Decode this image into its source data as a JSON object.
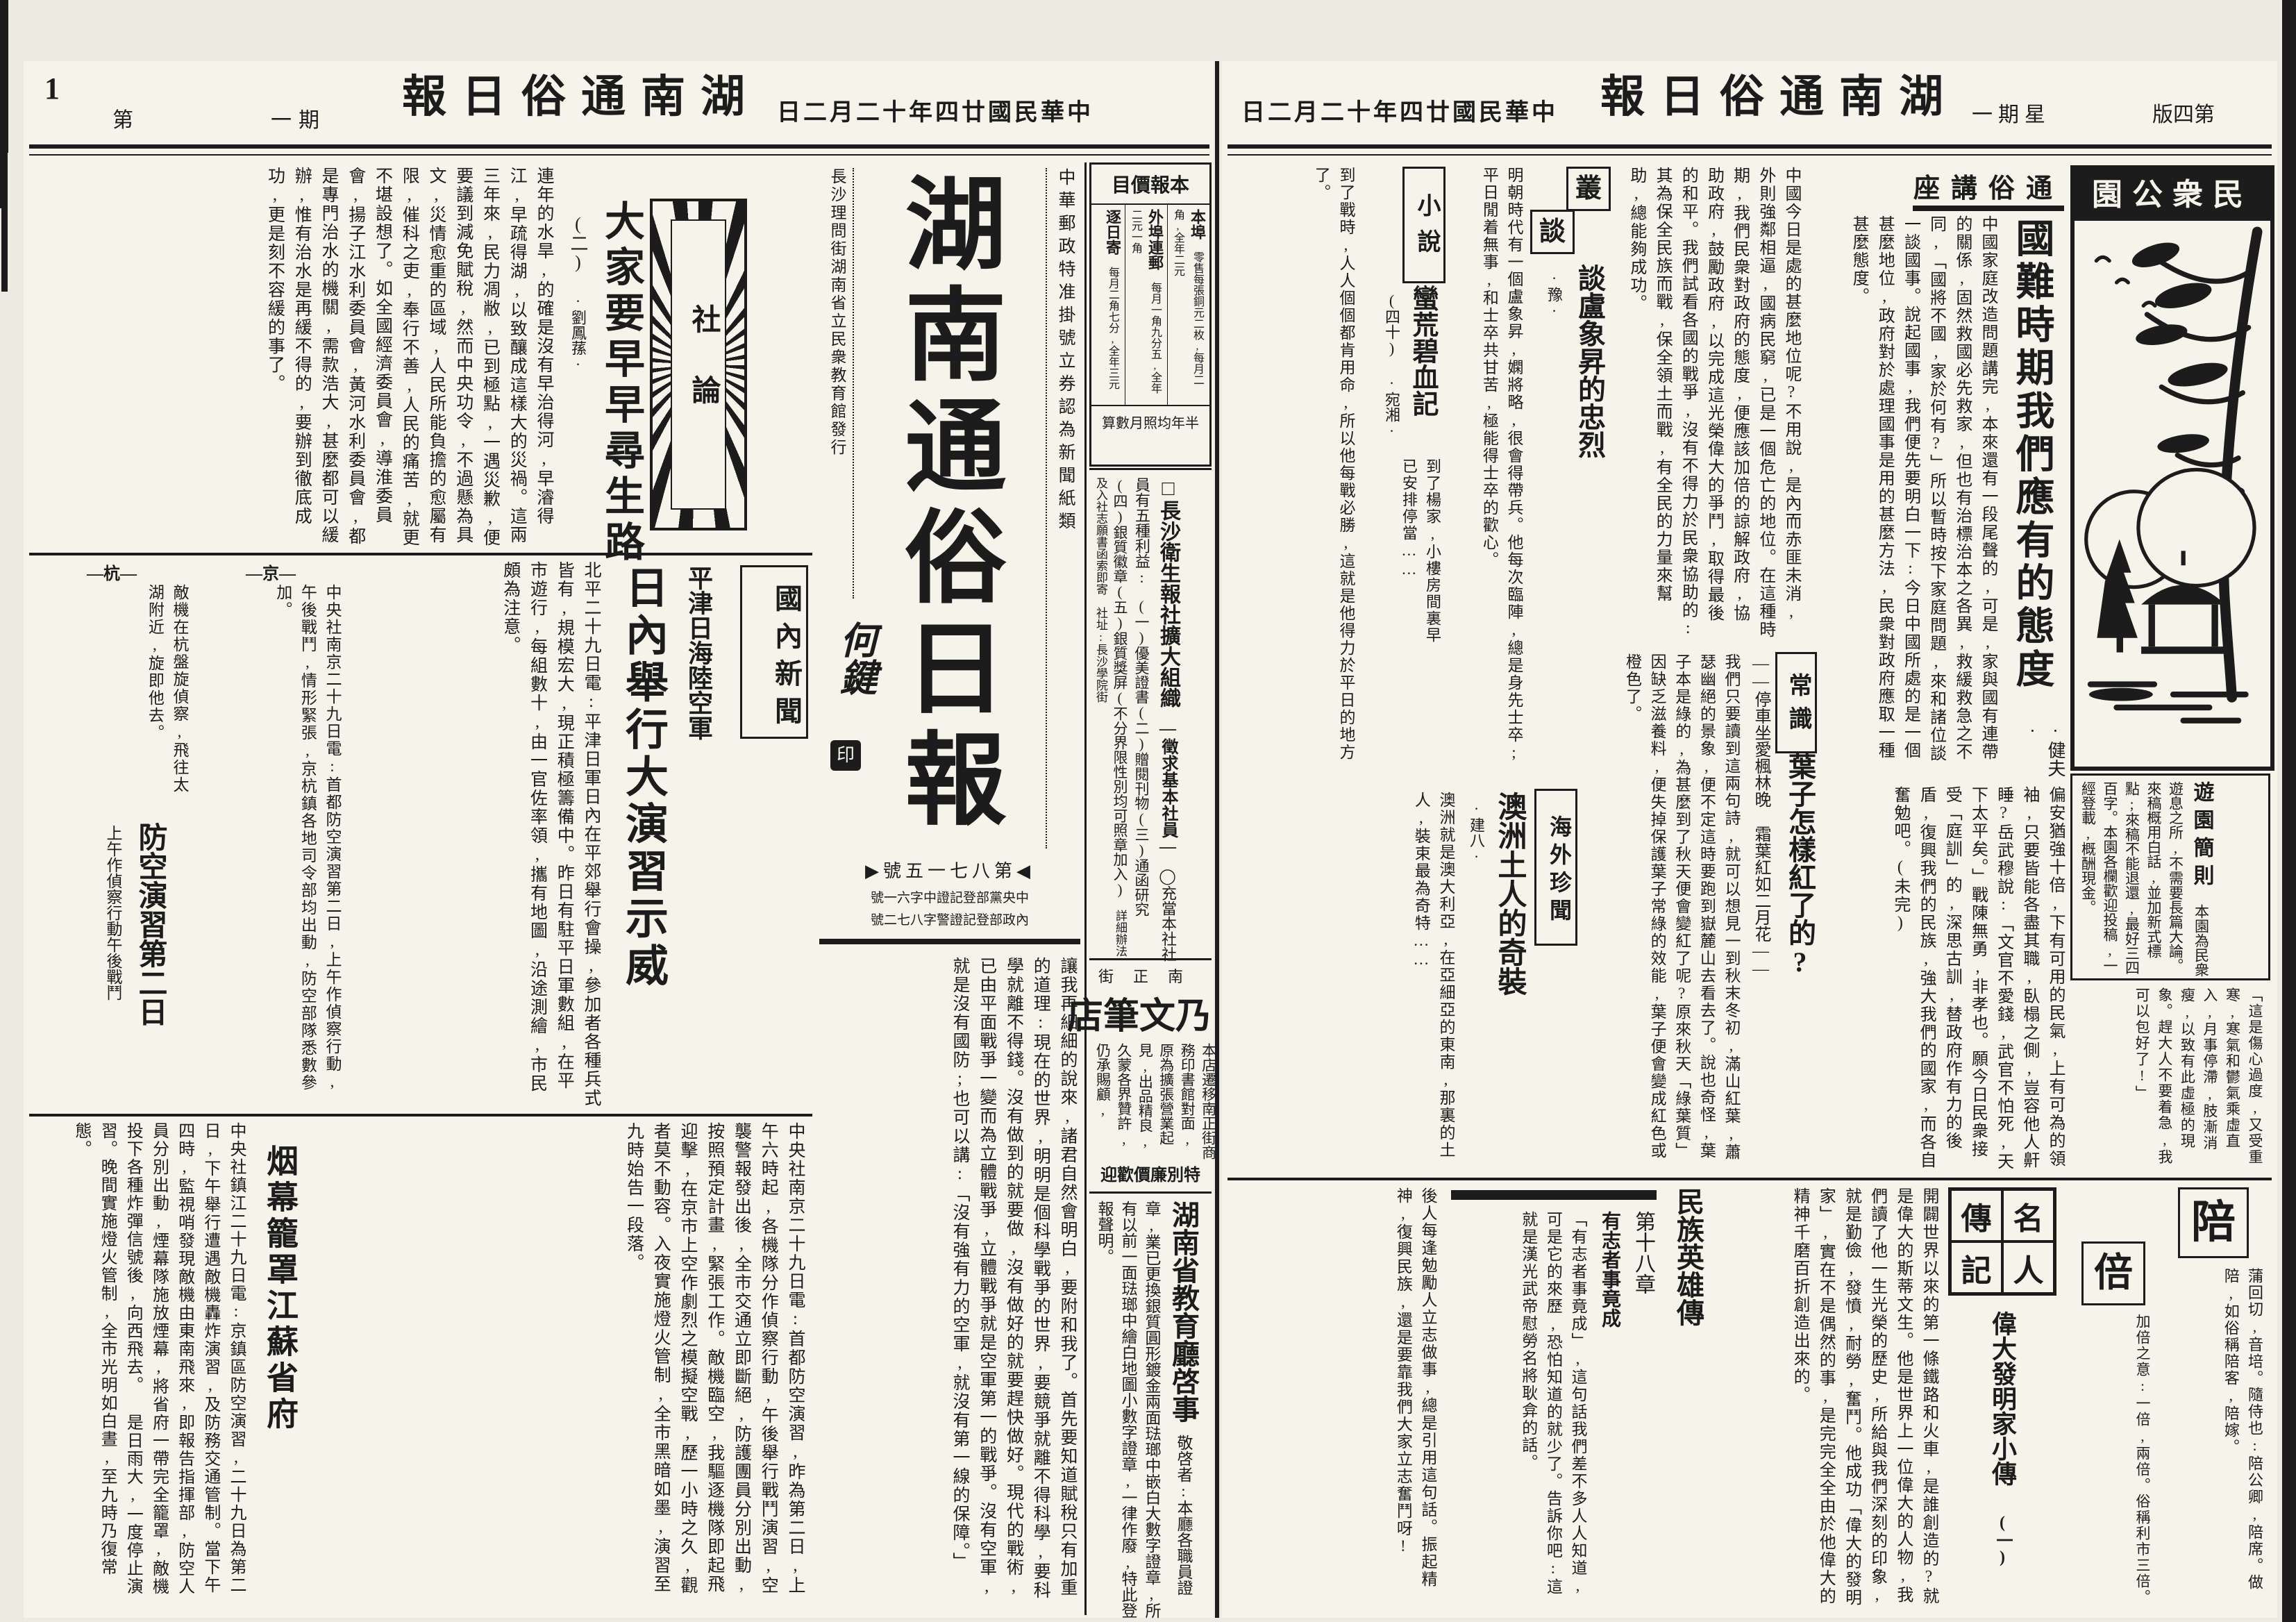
{
  "colors": {
    "ink": "#1c1c1c",
    "paper": "#f5f3ea"
  },
  "left": {
    "header": {
      "num": "1",
      "tag1": "第",
      "tag2": "一期",
      "masthead": "湖南通俗日報",
      "date": "中華民國廿四年十二月二日"
    },
    "price": {
      "title": "本報價目",
      "c0": {
        "name": "本埠",
        "val": "零售每張銅元二枚,每月二角,全年二元"
      },
      "c1": {
        "name": "外埠連郵",
        "val": "每月一角九分五,全年二元一角"
      },
      "c2": {
        "name": "逐日寄",
        "val": "每月二角七分,全年三元"
      },
      "footer": "半年均照月數算"
    },
    "masthead_block": {
      "postal": "中華郵政特准掛號立券認為新聞紙類",
      "title": "湖南通俗日報",
      "publisher": "長沙理問街湖南省立民衆教育館發行",
      "calligrapher": "何鍵",
      "seal": "印",
      "issue": "◀第八七一五號▶",
      "reg1": "中央黨部登記證中字六一號",
      "reg2": "內政部登記證警字八七二號"
    },
    "editorial": {
      "section": "社論",
      "title": "大家要早早尋生路",
      "part": "(二)",
      "author": "·劉鳳蓀·",
      "body": "連年的水旱,的確是沒有早治得河,早濬得江,早疏得湖,以致釀成這樣大的災禍。這兩三年來,民力凋敝,已到極點,一遇災歉,便要議到減免賦稅,然而中央功令,不過懸為具文,災情愈重的區域,人民所能負擔的愈屬有限,催科之吏,奉行不善,人民的痛苦,就更不堪設想了。如全國經濟委員會,導淮委員會,揚子江水利委員會,黃河水利委員會,都是專門治水的機關,需款浩大,甚麼都可以緩辦,惟有治水是再緩不得的,要辦到徹底成功,更是刻不容緩的事了。",
      "body2": "讓我再細細的說來,諸君自然會明白,要附和我了。首先要知道賦稅只有加重的道理:現在的世界,明明是個科學戰爭的世界,要競爭就離不得科學,要科學就離不得錢。沒有做到的就要做,沒有做好的就要趕快做好。現代的戰術,已由平面戰爭一變而為立體戰爭,立體戰爭就是空軍第一的戰爭。沒有空軍,就是沒有國防;也可以講:「沒有強有力的空軍,就沒有第一線的保障。」"
    },
    "domestic": {
      "section": "國內新聞",
      "kicker": "平津日海陸空軍",
      "headline": "日內舉行大演習示威",
      "body": "北平二十九日電:平津日軍日內在平郊舉行會操,參加者各種兵式皆有,規模宏大,現正積極籌備中。昨日有駐平日軍數組,在平市遊行,每組數十,由一官佐率領,攜有地圖,沿途測繪,市民頗為注意。",
      "item1_label": "—京—",
      "item1_text": "中央社南京二十九日電:首都防空演習第二日,上午作偵察行動,午後戰鬥,情形緊張,京杭鎮各地司令部均出動,防空部隊悉數參加。",
      "item2_label": "—杭—",
      "item2_text": "敵機在杭盤旋偵察,飛往太湖附近,旋即他去。"
    },
    "drill": {
      "headline": "防空演習第二日",
      "sub": "上午作偵察行動午後戰鬥",
      "body": "中央社南京二十九日電:首都防空演習,昨為第二日,上午六時起,各機隊分作偵察行動,午後舉行戰鬥演習,空襲警報發出後,全市交通立即斷絕,防護團員分別出動,按照預定計畫,緊張工作。敵機臨空,我驅逐機隊即起飛迎擊,在京市上空作劇烈之模擬空戰,歷一小時之久,觀者莫不動容。入夜實施燈火管制,全市黑暗如墨,演習至九時始告一段落。",
      "smoke_head": "烟幕籠罩江蘇省府",
      "smoke_body": "中央社鎮江二十九日電:京鎮區防空演習,二十九日為第二日,下午舉行遭遇敵機轟炸演習,及防務交通管制。當下午四時,監視哨發現敵機由東南飛來,即報告指揮部,防空人員分別出動,煙幕隊施放煙幕,將省府一帶完全籠罩,敵機投下各種炸彈信號後,向西飛去。",
      "side": "是日雨大,一度停止演習。晚間實施燈火管制,全市光明如白晝,至九時乃復常態。"
    },
    "ads": {
      "health_mark": "□",
      "health_title": "長沙衛生報社擴大組織",
      "health_sub": "—徵求基本社員—",
      "health_lead": "◯充當本社社員有五種利益:",
      "health_body": "(一)優美證書(二)贈閱刊物(三)通函研究(四)銀質徽章(五)銀質獎屏(不分界限性別均可照章加入)",
      "health_note": "詳細辦法及入社志願書函索即寄",
      "health_addr": "社址:長沙學院街",
      "pen_street": "南正街",
      "pen_name": "乃文筆店",
      "pen_body": "本店遷移南正街商務印書館對面,原為擴張營業起見,出品精良,久蒙各界贊許,仍承賜顧,",
      "pen_foot": "特別廉價歡迎",
      "edu_title": "湖南省教育廳啓事",
      "edu_body": "敬啓者:本廳各職員證章,業已更換銀質圓形鍍金兩面琺瑯中嵌白大數字證章,所有以前一面琺瑯中繪白地圖小數字證章,一律作廢,特此登報聲明。"
    }
  },
  "right": {
    "header": {
      "date": "中華民國廿四年十二月二日",
      "masthead": "湖南通俗日報",
      "weekday": "星期一",
      "page": "第四版"
    },
    "lecture": {
      "section": "通俗講座",
      "title": "國難時期我們應有的態度",
      "author": "·健夫·",
      "body": "中國家庭改造問題講完,本來還有一段尾聲的,可是,家與國有連帶的關係,固然救國必先救家,但也有治標治本之各異,救緩救急之不同,「國將不國,家於何有?」所以暫時按下家庭問題,來和諸位談一談國事。說起國事,我們便先要明白一下:今日中國所處的是一個甚麼地位,政府對於處理國事是用的甚麼方法,民衆對政府應取一種甚麼態度。",
      "body2": "中國今日是處的甚麼地位呢?不用說,是內而赤匪未消,外則強鄰相逼,國病民窮,已是一個危亡的地位。在這種時期,我們民衆對政府的態度,便應該加倍的諒解政府,協助政府,鼓勵政府,以完成這光榮偉大的爭鬥,取得最後的和平。我們試看各國的戰爭,沒有不得力於民衆協助的:其為保全民族而戰,保全領土而戰,有全民的力量來幫助,總能夠成功。",
      "body3": "偏安猶強十倍,下有可用的民氣,上有可為的領袖,只要皆能各盡其職,臥榻之側,豈容他人鼾睡?岳武穆說:「文官不愛錢,武官不怕死,天下太平矣。」戰陳無勇,非孝也。願今日民衆接受「庭訓」的,深思古訓,替政府作有力的後盾,復興我們的民族,強大我們的國家,而各自奮勉吧。(未完)"
    },
    "park": {
      "title": "民衆公園",
      "rules_title": "遊園簡則",
      "rules_body": "本園為民衆遊息之所,不需要長篇大論。來稿概用白話,並加新式標點;來稿不能退還,最好三四百字。本園各欄歡迎投稿,一經登載,概酬現金。"
    },
    "congtan": {
      "s1": "叢",
      "s2": "談",
      "title": "談盧象昇的忠烈",
      "author": "·豫·",
      "body": "明朝時代有一個盧象昇,嫻將略,很會得帶兵。他每次臨陣,總是身先士卒;平日閒着無事,和士卒共甘苦,極能得士卒的歡心。",
      "body2": "到了戰時,人人個個都肯用命,所以他每戰必勝,這就是他得力於平日的地方了。"
    },
    "changshi": {
      "section": "常識",
      "kicker": "——停車坐愛楓林晚 霜葉紅如二月花——",
      "title": "葉子怎樣紅了的?",
      "body": "我們只要讀到這兩句詩,就可以想見一到秋末冬初,滿山紅葉,蕭瑟幽絕的景象,便不定這時要跑到嶽麓山去看去了。說也奇怪,葉子本是綠的,為甚麼到了秋天便會變紅了呢?原來秋天「綠葉質」因缺乏滋養料,便失掉保護葉子常綠的效能,葉子便會變成紅色或橙色了。"
    },
    "novel": {
      "section": "小說",
      "title": "蠻荒碧血記",
      "part": "(四十)",
      "author": "·宛湘·",
      "body": "到了楊家,小樓房間裏早已安排停當……"
    },
    "overseas": {
      "section": "海外珍聞",
      "title": "澳洲土人的奇裝",
      "author": "·建八·",
      "body": "澳洲就是澳大利亞,在亞細亞的東南,那裏的土人,裝束最為奇特……"
    },
    "bio": {
      "section_cells": [
        "名",
        "傳",
        "人",
        "記"
      ],
      "title": "偉大發明家小傳",
      "part": "(一)",
      "body": "開闢世界以來的第一條鐵路和火車,是誰創造的?就是偉大的斯蒂文生。他是世界上一位偉大的人物,我們讀了他一生光榮的歷史,所給與我們深刻的印象,就是勤儉,發憤,耐勞,奮鬥。他成功「偉大的發明家」,實在不是偶然的事,是完完全全由於他偉大的精神千磨百折創造出來的。"
    },
    "hero": {
      "section": "民族英雄傳",
      "chapter": "第十八章",
      "motto": "有志者事竟成",
      "body": "「有志者事竟成」,這句話我們差不多人人知道,可是它的來歷,恐怕知道的就少了。告訴你吧:這就是漢光武帝慰勞名將耿弇的話。",
      "body2": "後人每逢勉勵人立志做事,總是引用這句話。振起精神,復興民族,還是要靠我們大家立志奮鬥呀!"
    },
    "story_frag": "「這是傷心過度,又受重寒,寒氣和鬱氣乘虛直入,月事停滯,肢漸消瘦,以致有此虛極的現象。趕大人不要着急,我可以包好了!」",
    "zike": {
      "e0_char": "陪",
      "e0_gloss": "蒲回切,音培。隨侍也:陪公卿,陪席。做陪,如俗稱陪客,陪嫁。",
      "e1_char": "倍",
      "e1_gloss": "加倍之意:一倍,兩倍。俗稱利市三倍。"
    }
  }
}
